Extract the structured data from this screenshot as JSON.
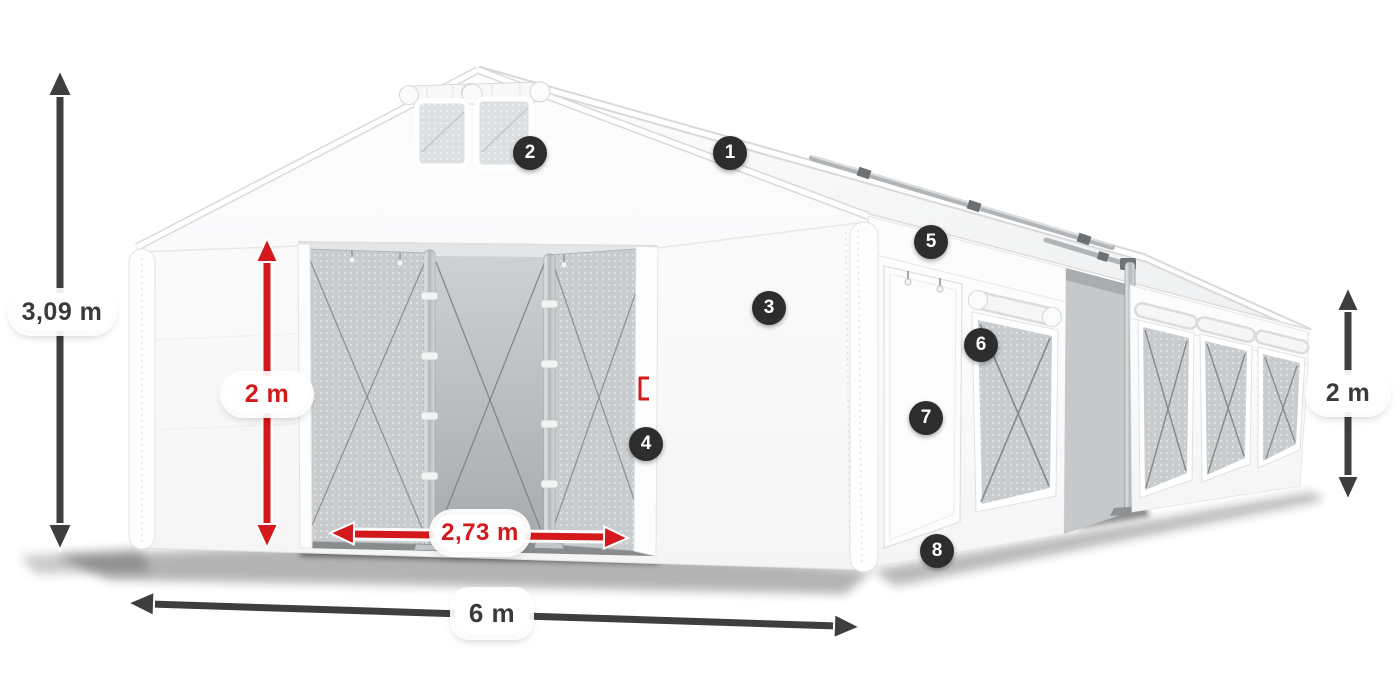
{
  "colors": {
    "background": "#ffffff",
    "dimension_dark": "#3e3e40",
    "dimension_red": "#d3191c",
    "badge_background": "#2d2d2d",
    "badge_number": "#ffffff",
    "label_background": "#ffffff",
    "label_text_dark": "#3a3a3a",
    "tent_white": "#fdfdfd",
    "mesh_gray": "#c8ccce"
  },
  "dimensions": [
    {
      "id": "total-height",
      "value": "3,09 m",
      "style": "dark",
      "orientation": "vertical"
    },
    {
      "id": "entrance-height",
      "value": "2 m",
      "style": "red",
      "orientation": "vertical"
    },
    {
      "id": "entrance-width",
      "value": "2,73 m",
      "style": "red",
      "orientation": "horizontal"
    },
    {
      "id": "overall-width",
      "value": "6 m",
      "style": "dark",
      "orientation": "horizontal"
    },
    {
      "id": "side-height",
      "value": "2 m",
      "style": "dark",
      "orientation": "vertical"
    }
  ],
  "callouts": [
    {
      "number": "1"
    },
    {
      "number": "2"
    },
    {
      "number": "3"
    },
    {
      "number": "4"
    },
    {
      "number": "5"
    },
    {
      "number": "6"
    },
    {
      "number": "7"
    },
    {
      "number": "8"
    }
  ]
}
